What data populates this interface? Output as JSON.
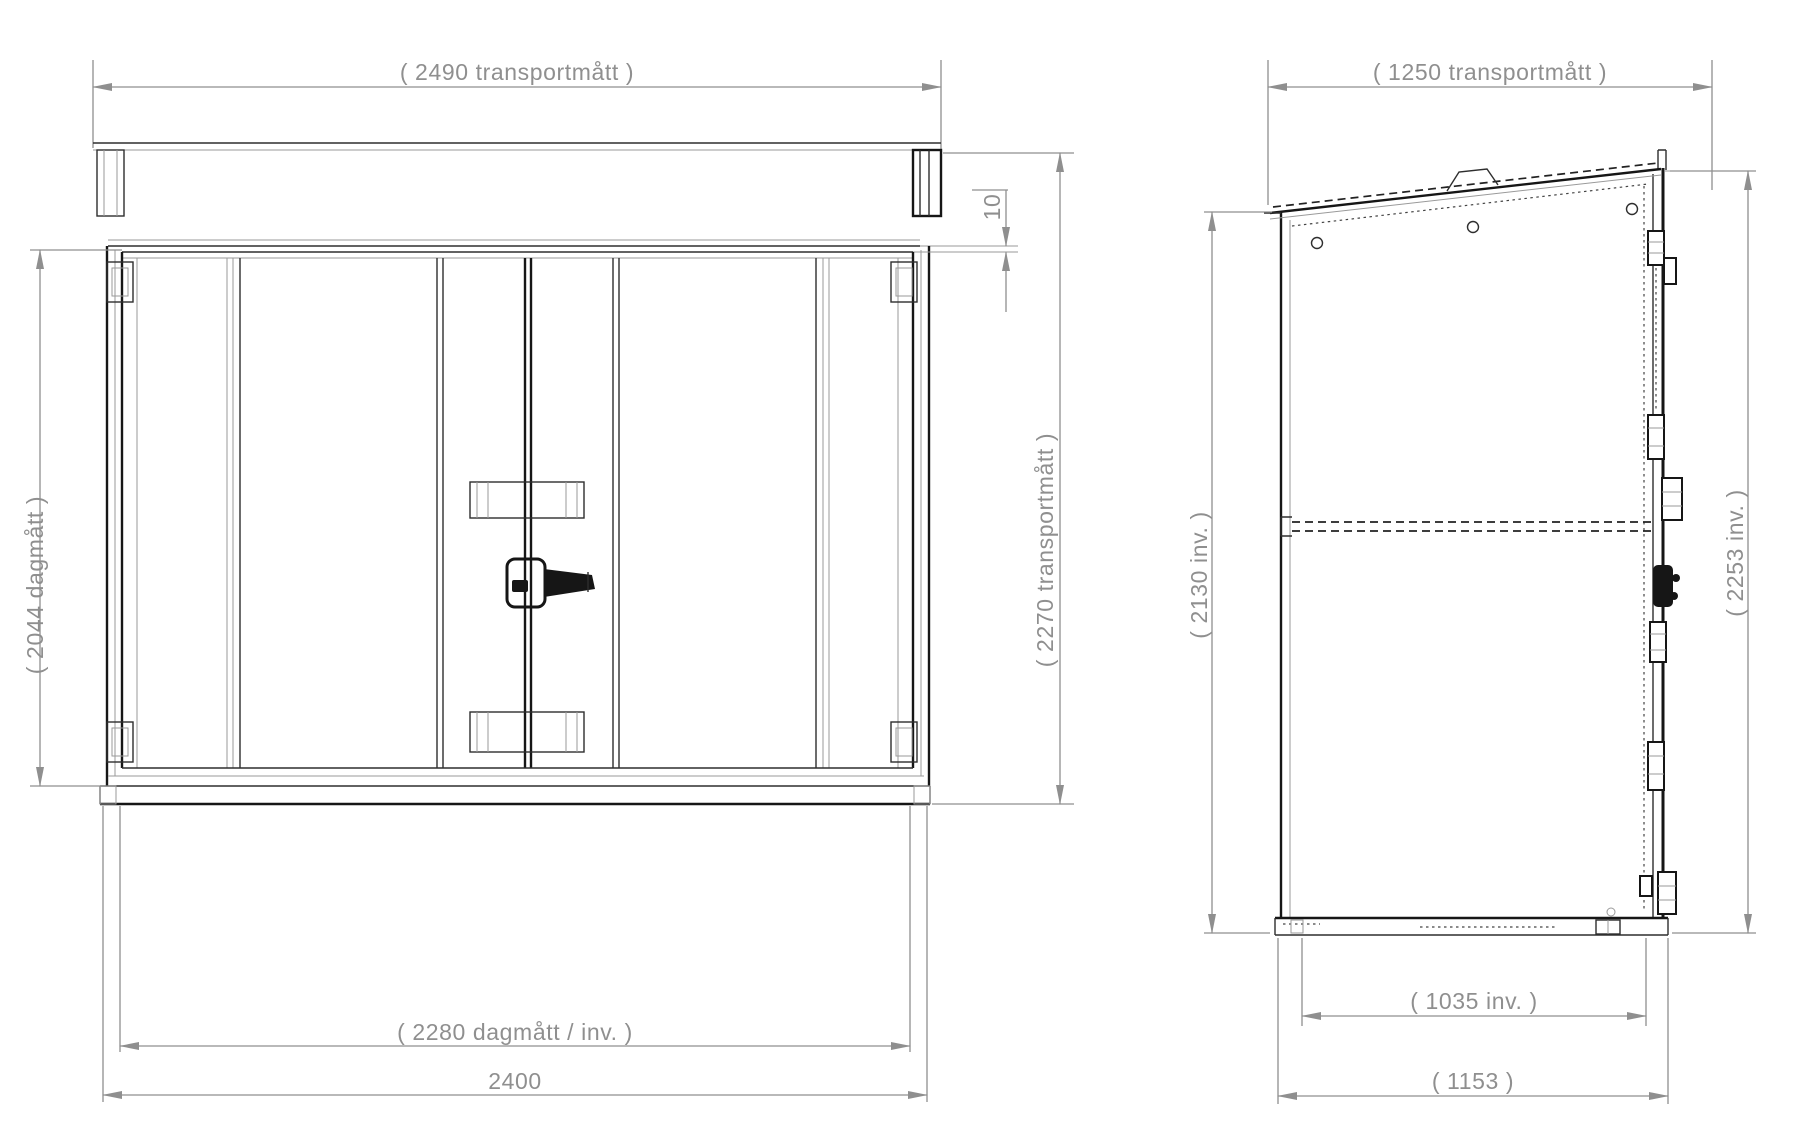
{
  "front_view": {
    "width_transport": "( 2490 transportmått )",
    "height_opening": "( 2044 dagmått )",
    "roof_gap": "10",
    "height_transport": "( 2270 transportmått )",
    "width_opening": "( 2280 dagmått / inv. )",
    "width_base": "2400"
  },
  "side_view": {
    "depth_transport": "( 1250 transportmått )",
    "height_inner": "( 2130 inv. )",
    "height_inner_door": "( 2253 inv. )",
    "depth_inner": "( 1035 inv. )",
    "depth_base": "( 1153 )"
  },
  "colors": {
    "geometry_line": "#161616",
    "dimension_line": "#8f8f8f",
    "background": "#ffffff"
  }
}
